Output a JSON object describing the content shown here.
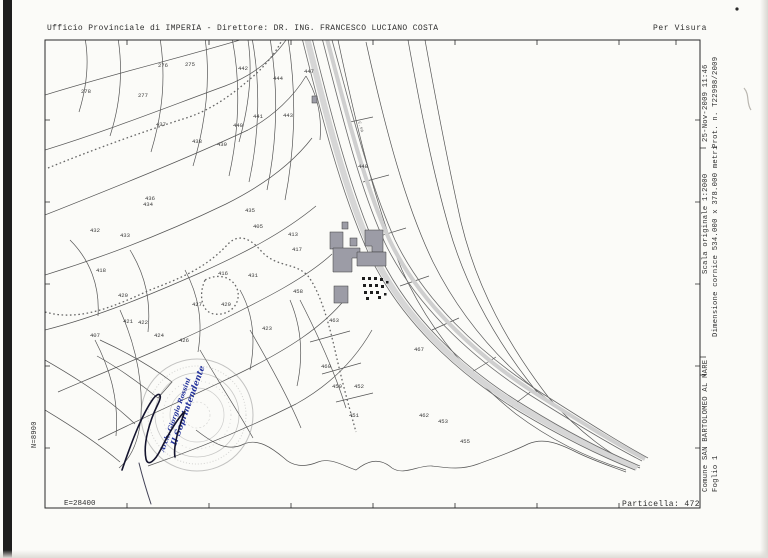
{
  "header": {
    "left": "Ufficio Provinciale di IMPERIA - Direttore: DR. ING. FRANCESCO LUCIANO COSTA",
    "right": "Per Visura"
  },
  "right_margin": {
    "date_line": "25-Nov-2009 11:46",
    "protocol_line": "Prot. n. T22998/2009",
    "scale_line": "Scala originale 1:2000",
    "frame_line": "Dimensione cornice 534.000 x 378.000 metri",
    "comune_line": "Comune  SAN BARTOLOMEO AL MARE",
    "foglio_line": "Foglio  1"
  },
  "left_margin": {
    "north_coord": "N=8900"
  },
  "bottom": {
    "east_coord": "E=28400",
    "particella": "Particella: 472"
  },
  "stamp": {
    "line1": "Il Soprintendente",
    "line2": "Arch. Giorgio Rossini",
    "ink_color": "#23329b"
  },
  "map": {
    "line_color": "#555555",
    "building_fill": "#9c9ca6",
    "road_label": {
      "text": "C.sa"
    },
    "parcels": [
      {
        "n": "278",
        "x": 86,
        "y": 93
      },
      {
        "n": "277",
        "x": 143,
        "y": 97
      },
      {
        "n": "276",
        "x": 163,
        "y": 67
      },
      {
        "n": "275",
        "x": 190,
        "y": 66
      },
      {
        "n": "442",
        "x": 243,
        "y": 70
      },
      {
        "n": "444",
        "x": 278,
        "y": 80
      },
      {
        "n": "447",
        "x": 309,
        "y": 73
      },
      {
        "n": "443",
        "x": 288,
        "y": 117
      },
      {
        "n": "441",
        "x": 258,
        "y": 118
      },
      {
        "n": "440",
        "x": 238,
        "y": 127
      },
      {
        "n": "439",
        "x": 222,
        "y": 146
      },
      {
        "n": "438",
        "x": 197,
        "y": 143
      },
      {
        "n": "437",
        "x": 161,
        "y": 126
      },
      {
        "n": "436",
        "x": 150,
        "y": 200
      },
      {
        "n": "448",
        "x": 363,
        "y": 168
      },
      {
        "n": "434",
        "x": 148,
        "y": 206
      },
      {
        "n": "435",
        "x": 250,
        "y": 212
      },
      {
        "n": "432",
        "x": 95,
        "y": 232
      },
      {
        "n": "433",
        "x": 125,
        "y": 237
      },
      {
        "n": "431",
        "x": 253,
        "y": 277
      },
      {
        "n": "429",
        "x": 226,
        "y": 306
      },
      {
        "n": "427",
        "x": 197,
        "y": 306
      },
      {
        "n": "418",
        "x": 101,
        "y": 272
      },
      {
        "n": "405",
        "x": 258,
        "y": 228
      },
      {
        "n": "416",
        "x": 223,
        "y": 275
      },
      {
        "n": "413",
        "x": 293,
        "y": 236
      },
      {
        "n": "417",
        "x": 297,
        "y": 251
      },
      {
        "n": "420",
        "x": 123,
        "y": 297
      },
      {
        "n": "421",
        "x": 128,
        "y": 323
      },
      {
        "n": "422",
        "x": 143,
        "y": 324
      },
      {
        "n": "407",
        "x": 95,
        "y": 337
      },
      {
        "n": "424",
        "x": 159,
        "y": 337
      },
      {
        "n": "426",
        "x": 184,
        "y": 342
      },
      {
        "n": "423",
        "x": 267,
        "y": 330
      },
      {
        "n": "458",
        "x": 298,
        "y": 293
      },
      {
        "n": "463",
        "x": 334,
        "y": 322
      },
      {
        "n": "460",
        "x": 326,
        "y": 368
      },
      {
        "n": "459",
        "x": 337,
        "y": 388
      },
      {
        "n": "452",
        "x": 359,
        "y": 388
      },
      {
        "n": "467",
        "x": 419,
        "y": 351
      },
      {
        "n": "462",
        "x": 424,
        "y": 417
      },
      {
        "n": "453",
        "x": 443,
        "y": 423
      },
      {
        "n": "455",
        "x": 465,
        "y": 443
      },
      {
        "n": "451",
        "x": 354,
        "y": 417
      }
    ]
  }
}
